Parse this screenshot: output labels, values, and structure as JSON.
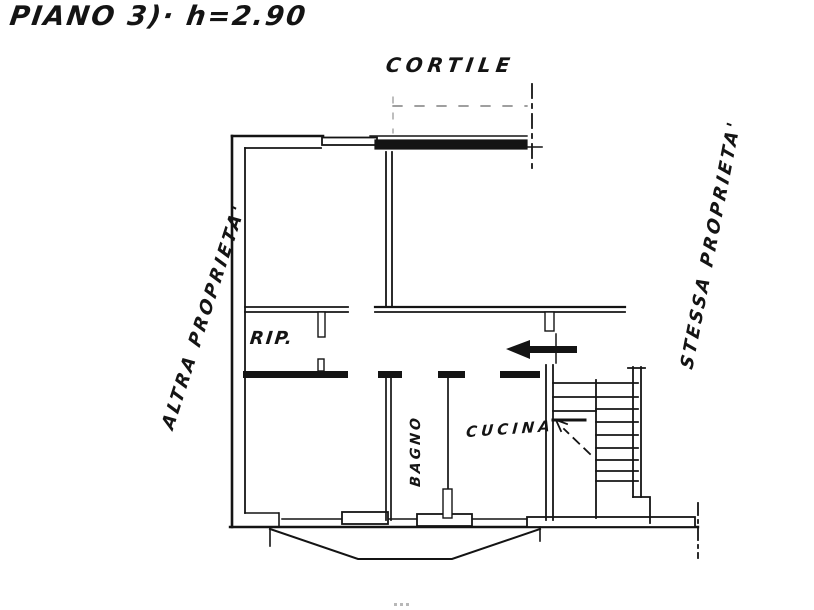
{
  "page": {
    "title": "PIANO 3)· h=2.90",
    "background_color": "#ffffff",
    "ink_color": "#141414"
  },
  "labels": {
    "courtyard": "CORTILE",
    "left_boundary": "ALTRA  PROPRIETA'",
    "right_boundary": "STESSA  PROPRIETA'",
    "storage_room": "RIP.",
    "bathroom": "BAGNO",
    "kitchen": "CUCINA"
  }
}
